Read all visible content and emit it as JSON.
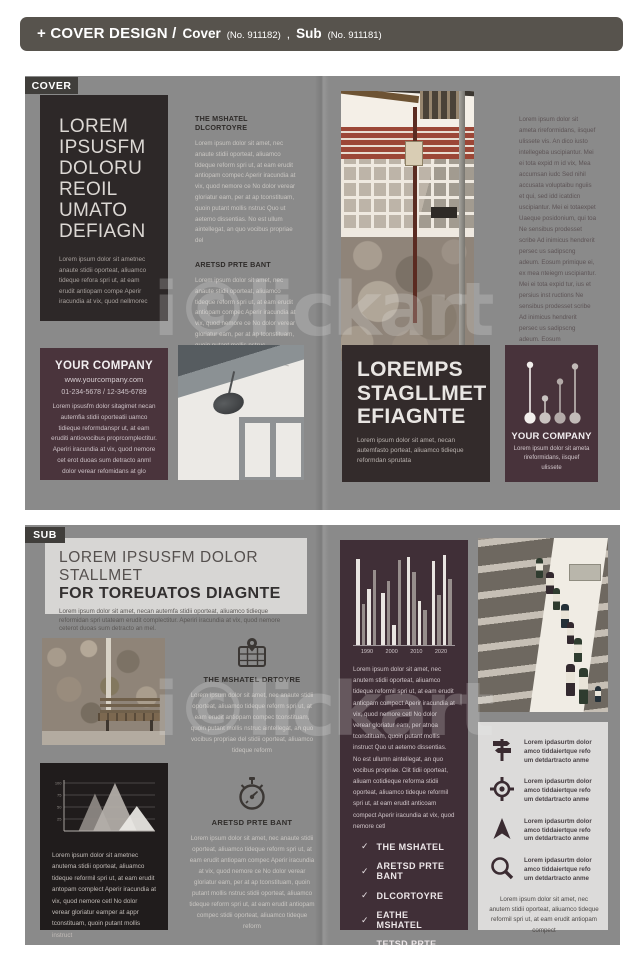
{
  "header": {
    "title": "+ COVER DESIGN /",
    "items": [
      {
        "label": "Cover",
        "no": "(No. 911182)"
      },
      {
        "label": "Sub",
        "no": "(No. 911181)"
      }
    ],
    "separator": ","
  },
  "watermark": {
    "text": "i©lickart"
  },
  "check_glyph": "✓",
  "colors": {
    "header_bar": "#57534d",
    "spread_bg": "#8a8a8a",
    "tab_bg": "#403e3b",
    "dark_panel": "#2d2828",
    "near_black_panel": "#201c1c",
    "maroon_panel": "#4a343c",
    "maroon_deep_panel": "#402f37",
    "light_panel": "#d7d6d4"
  },
  "cover": {
    "tab": "COVER",
    "left_panel": {
      "title_lines": [
        "LOREM",
        "IPSUSFM",
        "DOLORU",
        "REOIL",
        "UMATO",
        "DEFIAGN"
      ],
      "body": "Lorem ipsum dolor sit ametnec anaute stidii oporteat, aliuamco tideque refora spri ut, at eam erudit antiopam compe Aperir iracundia at vix, quod nellmorec"
    },
    "middle_sections": [
      {
        "heading": "THE MSHATEL DLCORTOYRE",
        "body": "Lorem ipsum dolor sit amet, nec anaute stidii oporteat, aliuamco tideque reform spri ut, at eam erudit antiopam compec Aperir iracundia at vix, quod nemore ce No dolor verear gloriatur eam, per at ap tconstituam, quoin putant mollis nstruc Quo ut aetemo dissentias. No est ullum aintellegat, an quo vocibus propriae del"
      },
      {
        "heading": "ARETSD PRTE BANT",
        "body": "Lorem ipsum dolor sit amet, nec anaute stidii oporteat, aliuamco tideque reform spri ut, at eam erudit antiopam compec Aperir iracundia at vix, quod nemore ce No dolor verear gloriatur eam, per at ap tconstituam, quoin putant mollis nstruc"
      }
    ],
    "right_column": {
      "body": "Lorem ipsum dolor sit ameta rireformidans, iisquef ulissete vis. An dico iusto intellegeba uscipiantur. Mei ei tota expid m id vix, Mea accumsan iudc Sed nihil accusata voluptaibu nguiis et qui, sed idd icatdicn uscipiantur. Mei ei totaexpet Uaeque posidonium, qui toa Ne sensibus prodesset scribe Ad inimicus hendrerit persec us sadipscng adeum. Eosum primique ei, ex mea nteiegm uscipiantur. Mei ei tota expid tur, ius et persius inst ructions Ne sensibus prodesset scribe Ad inimicus hendrerit persec us sadipscng adeum. Eosum"
    },
    "company_panel": {
      "title": "YOUR COMPANY",
      "url": "www.yourcompany.com",
      "phones": "01-234-5678  /  12-345-6789",
      "body": "Lorem ipsusfm dolor sitagimet necan autemfia stidii oporteatii uamco tidieque reformdanspr ut, at eam eruditi antiovocibus proprcomplectitur. Aperiri iracundia at vix, quod nemore cet erot duoas sum detracto anml dolor verear refomidans at glo"
    },
    "loremps_panel": {
      "title_lines": [
        "LOREMPS",
        "STAGLLMET",
        "EFIAGNTE"
      ],
      "body": "Lorem ipsum dolor sit amet, necan autemfasto porteat, aliuamco tidieque reformdan sprutata"
    },
    "company_panel2": {
      "icon": "lollipop-chart-icon",
      "title": "YOUR COMPANY",
      "body": "Lorem ipsum dolor sit ameta rireformidans, iisquef ulissete"
    }
  },
  "sub": {
    "tab": "SUB",
    "header_box": {
      "title_line1": "LOREM IPSUSFM DOLOR STALLMET",
      "title_line2": "FOR TOREUATOS DIAGNTE",
      "body": "Lorem ipsum dolor sit amet, necan autemfa stidii oporteat, aliuamco tidieque reformidan spri utateam erudit complectitur. Aperiri iracundia at vix, quod nemore ceterot duoas sum detracto an mel."
    },
    "middle_sections": [
      {
        "icon": "map-pin-icon",
        "heading": "THE MSHATEL DRTOYRE",
        "body": "Lorem ipsum dolor sit amet, nec anaute stidii oporteat, aliuamco tideque reform spri ut, at eam erudit antiopam compec tconstituam, quoin putant mollis nstruc aintellegat, an quo vocibus propriae del stidii oporteat, aliuamco tideque reform"
      },
      {
        "icon": "stopwatch-icon",
        "heading": "ARETSD PRTE BANT",
        "body": "Lorem ipsum dolor sit amet, nec anaute stidii oporteat, aliuamco tideque reform spri ut, at eam erudit antiopam compec Aperir iracundia at vix, quod nemore ce No dolor verear gloriatur eam, per at ap tconstituam, quoin putant mollis nstruc stidii oporteat, aliuamco tideque reform spri ut, at eam erudit antiopam compec stidii oporteat, aliuamco tideque reform"
      }
    ],
    "chart_panel": {
      "body": "Lorem ipsum dolor sit ametnec anutema stidii oporteat, aliuamco tideque reformil spri ut, at eam erudit antopam complect Aperir iracundia at vix, quod nemore cetl No dolor verear gloriatur eamper at appr tconstituam, quoin putant mollis instruct"
    },
    "center_panel": {
      "body": "Lorem ipsum dolor sit amet, nec anutem stidii oporteat, aliuamco tideque reformil spri ut, at eam erudit anticpam compect Aperir iracundia at vix, quod nemore cetl No dolor verear gloriatur eam, per atnoa tconstituam, quoin putant mollis instruct Quo ut aetemo dissentias. No est ullumn aintellegat, an quo vocibus propriae. Clit tidii oporteat, aliuam cotidieque reforma stidii oporteat, aliuamco tideque reformil spri ut, at eam erudit anticoam compect Aperir iracundia at vix, quod nemore cetl",
      "checklist": [
        "THE MSHATEL",
        "ARETSD PRTE BANT",
        "DLCORTOYRE",
        "EATHE MSHATEL",
        "TETSD PRTE BANT"
      ]
    },
    "right_panel": {
      "items": [
        {
          "icon": "signpost-icon",
          "text": "Lorem ipdasurtm dolor amco tiddaiertque refo um detdartracto anme"
        },
        {
          "icon": "target-icon",
          "text": "Lorem ipdasurtm dolor amco tiddaiertque refo um detdartracto anme"
        },
        {
          "icon": "navigation-arrow-icon",
          "text": "Lorem ipdasurtm dolor amco tiddaiertque refo um detdartracto anme"
        },
        {
          "icon": "magnifier-icon",
          "text": "Lorem ipdasurtm dolor amco tiddaiertque refo um detdartracto anme"
        }
      ],
      "footer": "Lorem ipsum dolor sit amet, nec anutem stidii oporteat, aliuamco tideque reformil spri ut, at eam erudit antiopam compect"
    }
  },
  "chart_data": [
    {
      "id": "sub-grouped-bar-chart",
      "type": "bar",
      "title": "",
      "categories": [
        "1990",
        "2000",
        "2010",
        "2020"
      ],
      "groups": [
        [
          95,
          45,
          62,
          82
        ],
        [
          57,
          70,
          22,
          93
        ],
        [
          97,
          80,
          48,
          38
        ],
        [
          92,
          55,
          99,
          72
        ]
      ],
      "bar_colors": [
        "#e9e5e1",
        "#978e8c"
      ],
      "ylim": [
        0,
        100
      ],
      "grid": false,
      "note": "decorative grouped bars above year labels"
    },
    {
      "id": "sub-triangle-area-chart",
      "type": "area",
      "yticks": [
        100,
        75,
        50,
        25
      ],
      "triangles": [
        {
          "peak": 78,
          "base": [
            16,
            52
          ],
          "color": "#8f8a85"
        },
        {
          "peak": 100,
          "base": [
            32,
            80
          ],
          "color": "#b5b0aa"
        },
        {
          "peak": 52,
          "base": [
            60,
            100
          ],
          "color": "#ebe9e5"
        }
      ],
      "ylim": [
        0,
        100
      ],
      "grid": true
    },
    {
      "id": "cover-lollipop-icon-chart",
      "type": "lollipop",
      "values": [
        95,
        35,
        65,
        92
      ],
      "colors": [
        "#f2efec",
        "#c9c3c0",
        "#b3aaa8",
        "#c2bbb8"
      ]
    }
  ]
}
